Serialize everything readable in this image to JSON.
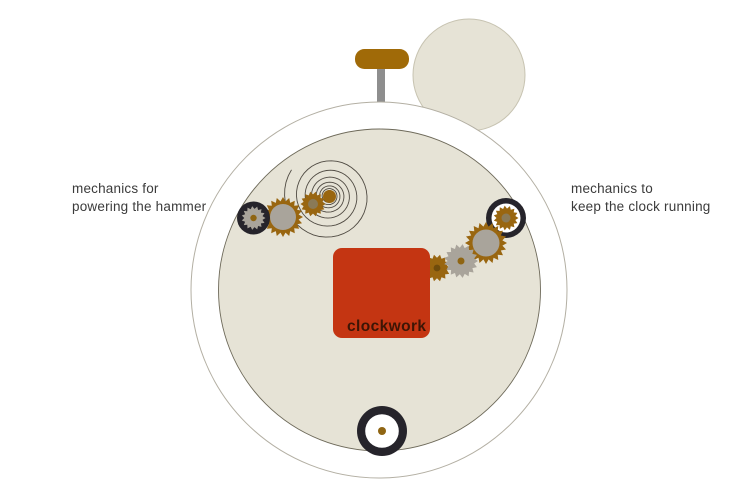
{
  "diagram": {
    "left_label": {
      "line1": "mechanics for",
      "line2": "powering the hammer"
    },
    "right_label": {
      "line1": "mechanics to",
      "line2": "keep the clock running"
    },
    "clockwork_label": "clockwork"
  },
  "colors": {
    "background": "#ffffff",
    "clock_face": "#e6e3d6",
    "face_edge": "#6e6a5a",
    "outer_edge": "#b3afa3",
    "bell_edge": "#c7c3b1",
    "red_square": "#c43512",
    "clockwork_text": "#3d1505",
    "gear_gold": "#996610",
    "gear_gray": "#a9a49b",
    "gear_black": "#26242b",
    "hammer_gold": "#a06a08",
    "stem_gray": "#8e8e8e",
    "hub_brown": "#8f6513",
    "hub_taupe": "#8a7a57",
    "hub_dark": "#6f4c0c",
    "spiral_stroke": "#4f4a42",
    "label_text": "#3b3b3b"
  }
}
